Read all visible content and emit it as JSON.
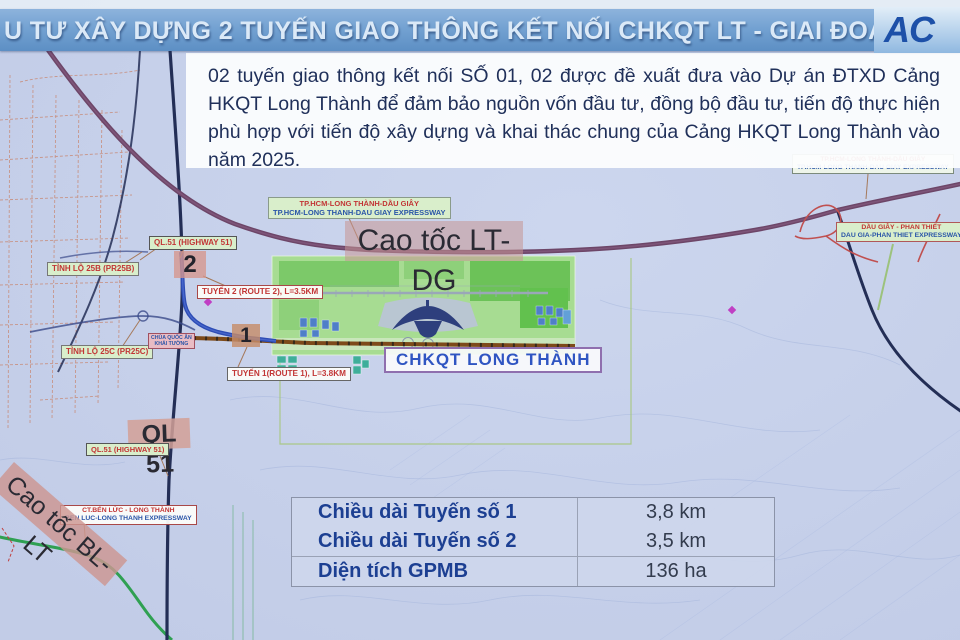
{
  "title_bar": {
    "title": "U TƯ XÂY DỰNG 2 TUYẾN GIAO THÔNG KẾT NỐI CHKQT LT - GIAI ĐOẠN 1",
    "logo": "AC"
  },
  "intro": {
    "text": "02 tuyến giao thông kết nối SỐ 01, 02 được đề xuất đưa vào Dự án ĐTXD Cảng HKQT Long Thành để đảm bảo nguồn vốn đầu tư, đồng bộ đầu tư, tiến độ thực hiện phù hợp với tiến độ xây dựng và khai thác chung của Cảng HKQT Long Thành vào năm 2025."
  },
  "map": {
    "labels": {
      "expwy_mid_vn": "TP.HCM-LONG THÀNH-DẦU GIÂY",
      "expwy_mid_en": "TP.HCM-LONG THANH-DAU GIAY EXPRESSWAY",
      "expwy_right_vn": "TP.HCM-LONG THÀNH-DẦU GIÂY",
      "expwy_right_en": "TP.HCM-LONG THANH-DAU GIAY EXPRESSWAY",
      "caotoc_ltdg": "Cao tốc LT-DG",
      "dgpt_vn": "DẦU GIÂY - PHAN THIẾT",
      "dgpt_en": "DAU GIA-PHAN THIET EXPRESSWAY",
      "ql51_hw_top": "QL.51 (HIGHWAY 51)",
      "ql51_hw_bottom": "QL.51 (HIGHWAY 51)",
      "tl25b": "TỈNH LỘ 25B (PR25B)",
      "tl25c": "TỈNH LỘ 25C (PR25C)",
      "num2": "2",
      "num1": "1",
      "route2": "TUYẾN 2 (ROUTE 2), L=3.5KM",
      "route1": "TUYẾN 1(ROUTE 1), L=3.8KM",
      "chua_line1": "CHÙA QUỐC ÂN",
      "chua_line2": "KHẢI TƯỜNG",
      "airport": "CHKQT LONG THÀNH",
      "ql51_big": "QL 51",
      "caotoc_bllt": "Cao tốc BL-LT",
      "bllt_vn": "CT.BẾN LỨC - LONG THÀNH",
      "bllt_en": "BEN LUC-LONG THANH EXPRESSWAY"
    }
  },
  "stats_table": {
    "rows": [
      {
        "label": "Chiều dài Tuyến số 1",
        "value": "3,8 km"
      },
      {
        "label": "Chiều dài Tuyến số 2",
        "value": "3,5 km"
      },
      {
        "label": "Diện tích GPMB",
        "value": "136 ha"
      }
    ]
  },
  "colors": {
    "map-bg": "#c6d0ea",
    "bar-blue-1": "#8db3dc",
    "bar-blue-2": "#5d8fc4",
    "title-text": "#dbe9f7",
    "logo-blue": "#1d50a8",
    "panel-bg": "#fbfcfd",
    "body-text": "#20305a",
    "label-green-bg": "#d9eecb",
    "label-red": "#c23535",
    "label-blue": "#2a55a8",
    "ltdg-road": "#6d4668",
    "navy-road": "#232e56",
    "route1-brown": "#7d4a1a",
    "route2-blue": "#2d4cb5",
    "green-road": "#2fa052",
    "red-road": "#c05050",
    "airport-green": "#a7dc92",
    "table-bg": "#ced6ec",
    "table-label": "#1c3f92",
    "table-value": "#333c4e"
  }
}
